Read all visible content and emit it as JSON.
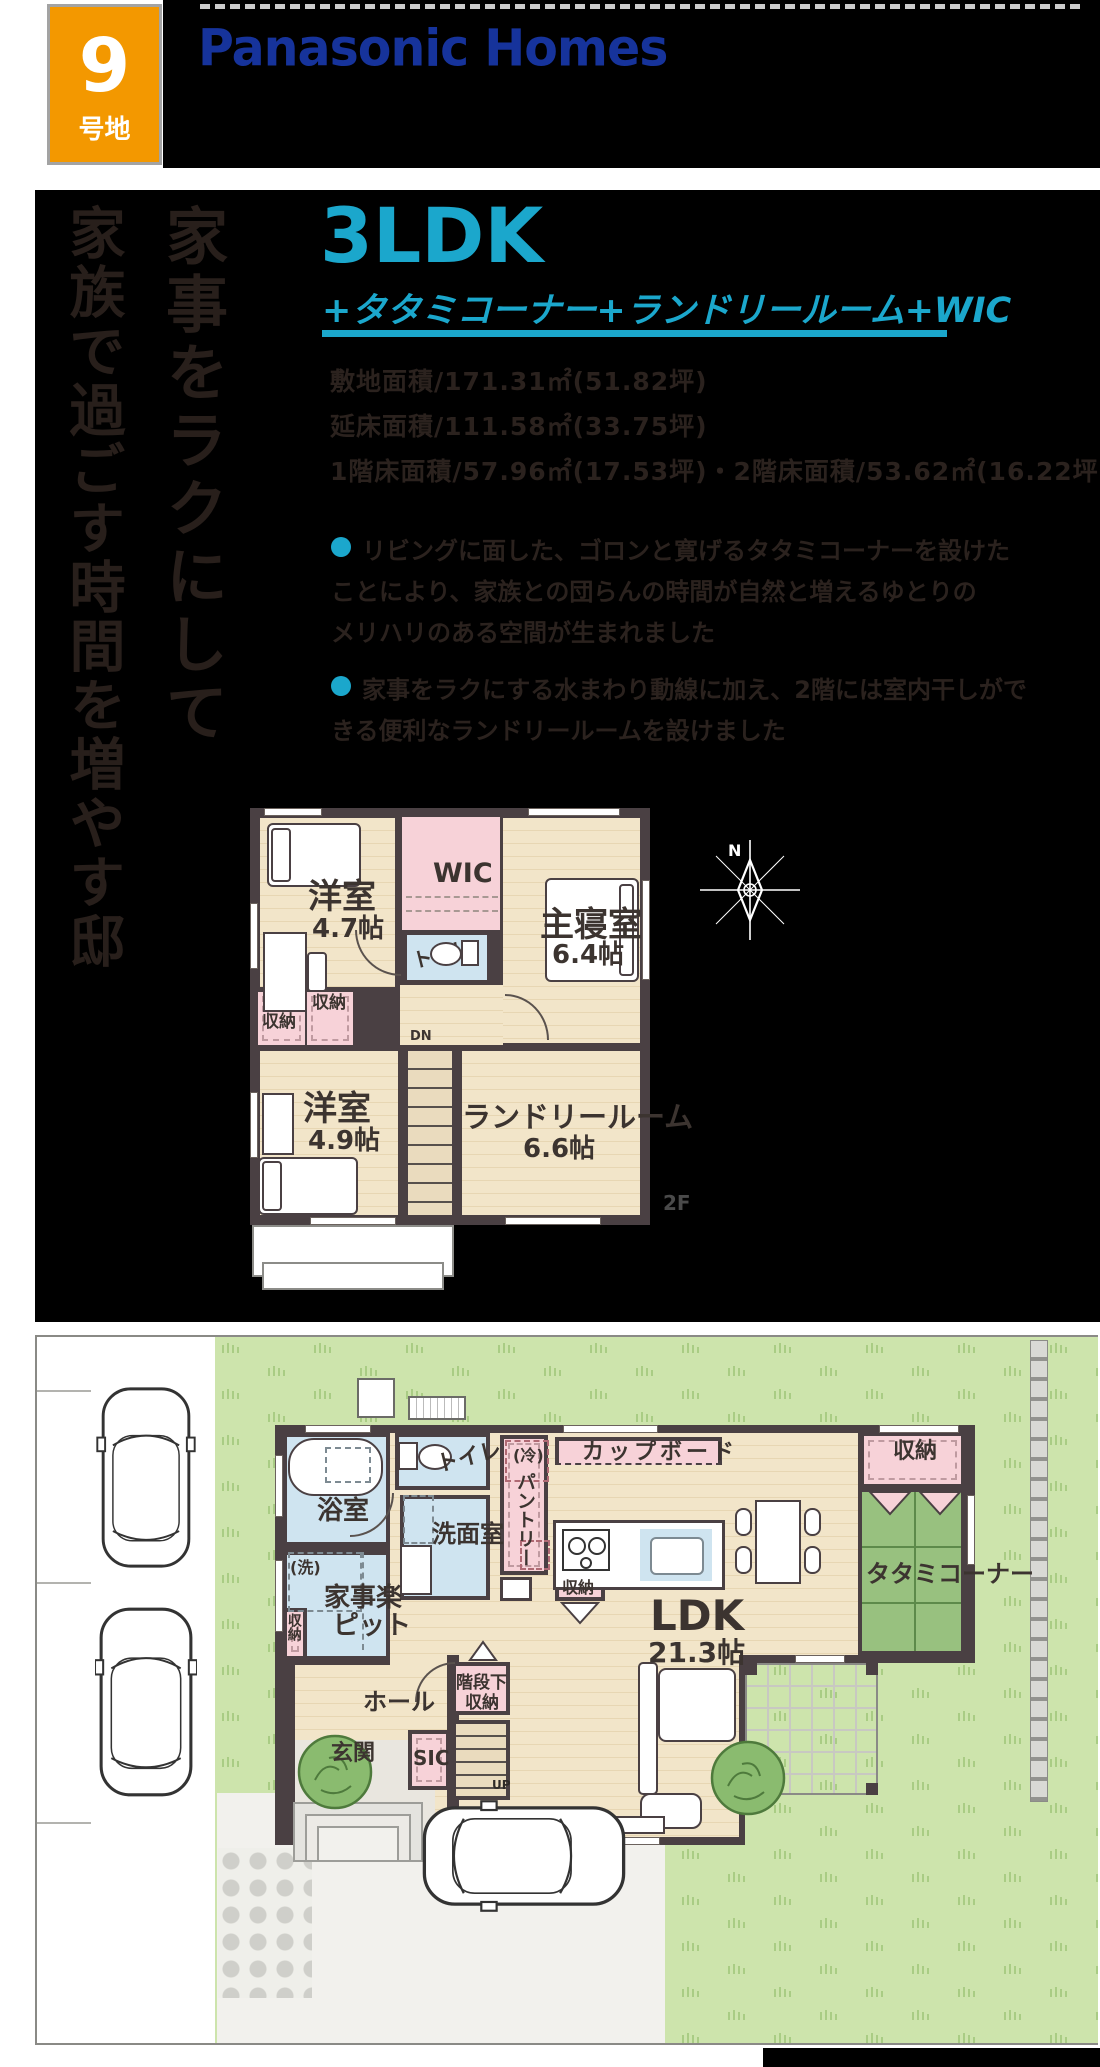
{
  "header": {
    "lot_number": "9",
    "lot_label": "号地",
    "brand": "Panasonic Homes"
  },
  "headline": {
    "col_right": "家事をラクにして",
    "col_left": "家族で過ごす時間を増やす邸"
  },
  "title": {
    "plan_type": "3LDK",
    "plan_sub": "+タタミコーナー+ランドリールーム+WIC"
  },
  "specs": {
    "site_area": "敷地面積/171.31㎡(51.82坪)",
    "total_floor_area": "延床面積/111.58㎡(33.75坪)",
    "floor_areas": "1階床面積/57.96㎡(17.53坪)・2階床面積/53.62㎡(16.22坪)"
  },
  "points": {
    "p1_line1": "リビングに面した、ゴロンと寛げるタタミコーナーを設けた",
    "p1_line2": "ことにより、家族との団らんの時間が自然と増えるゆとりの",
    "p1_line3": "メリハリのある空間が生まれました",
    "p2_line1": "家事をラクにする水まわり動線に加え、2階には室内干しがで",
    "p2_line2": "きる便利なランドリールームを設けました"
  },
  "common": {
    "storage": "収納",
    "toilet": "トイレ",
    "western_room": "洋室"
  },
  "plan2f": {
    "floor_tag": "2F",
    "dn": "DN",
    "wic": "WIC",
    "room1_size": "4.7帖",
    "master": "主寝室",
    "master_size": "6.4帖",
    "room2_size": "4.9帖",
    "laundry": "ランドリールーム",
    "laundry_size": "6.6帖",
    "compass_n": "N"
  },
  "plan1f": {
    "bath": "浴室",
    "washroom": "洗面室",
    "pantry": "パントリー",
    "fridge": "(冷)",
    "washer": "(洗)",
    "cupboard": "カップボード",
    "tatami": "タタミコーナー",
    "kaji_line1": "家事楽",
    "kaji_line2": "ピット",
    "hall": "ホール",
    "understairs_line1": "階段下",
    "understairs_line2": "収納",
    "genkan": "玄関",
    "sic": "SIC",
    "up": "UP",
    "ldk": "LDK",
    "ldk_size": "21.3帖"
  },
  "colors": {
    "accent_cyan": "#1BA7CC",
    "badge_orange": "#F39800",
    "logo_blue": "#16339B",
    "tatami_green": "#98C17F",
    "lawn_green": "#CDE4AC",
    "wall_gray": "#4A4043",
    "room_pink": "#F7D2D8",
    "room_blue": "#CFE4F0"
  }
}
